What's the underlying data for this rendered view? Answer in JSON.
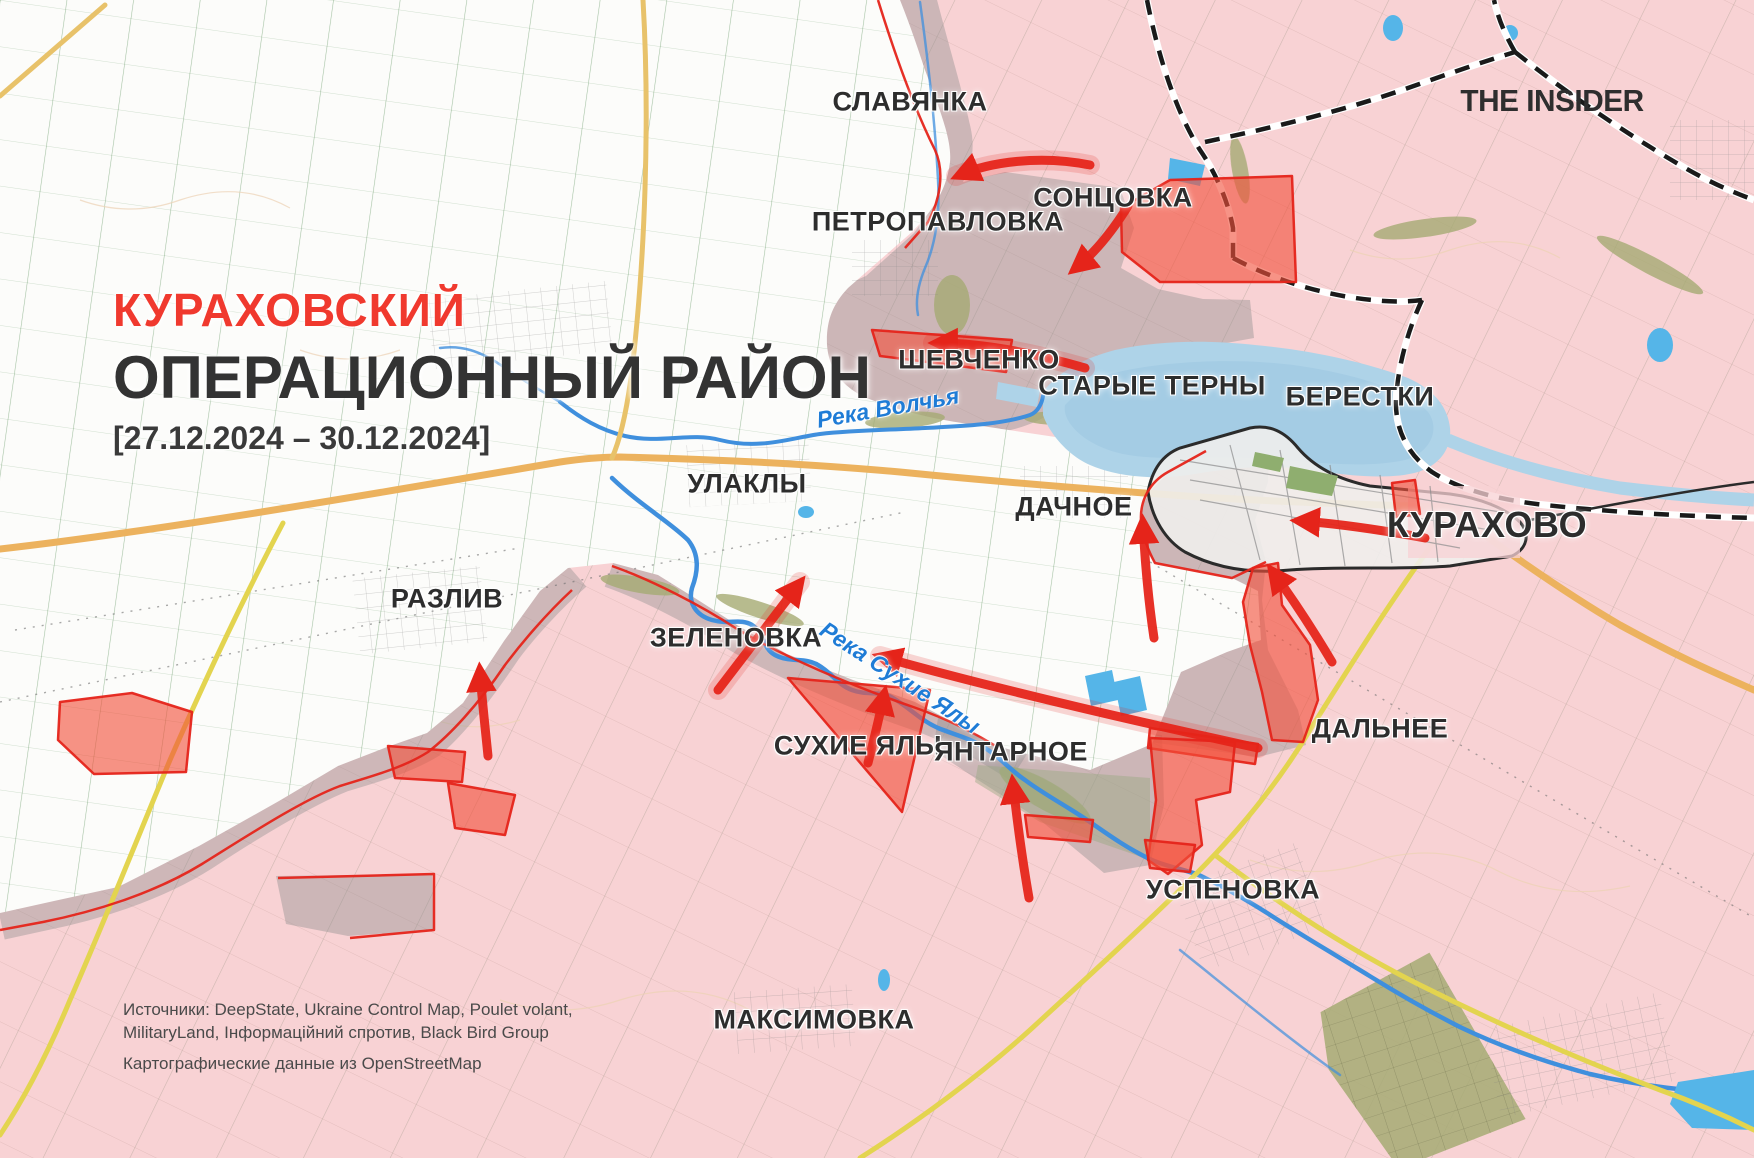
{
  "header": {
    "title_line1": "КУРАХОВСКИЙ",
    "title_line2": "ОПЕРАЦИОННЫЙ РАЙОН",
    "date_range": "[27.12.2024 – 30.12.2024]",
    "logo": "THE INSIDER"
  },
  "settlements": {
    "slavyanka": "СЛАВЯНКА",
    "petropavlovka": "ПЕТРОПАВЛОВКА",
    "sontsovka": "СОНЦОВКА",
    "shevchenko": "ШЕВЧЕНКО",
    "starye_terny": "СТАРЫЕ ТЕРНЫ",
    "berestki": "БЕРЕСТКИ",
    "ulakly": "УЛАКЛЫ",
    "dachnoe": "ДАЧНОЕ",
    "kurakhovo": "КУРАХОВО",
    "razliv": "РАЗЛИВ",
    "zelenovka": "ЗЕЛЕНОВКА",
    "sukhie_yaly": "СУХИЕ ЯЛЫ",
    "yantarnoe": "ЯНТАРНОЕ",
    "dalnee": "ДАЛЬНЕЕ",
    "uspenovka": "УСПЕНОВКА",
    "maksimovka": "МАКСИМОВКА"
  },
  "rivers": {
    "volchya": "Река Волчья",
    "sukhie_yaly": "Река Сухие Ялы"
  },
  "footer": {
    "sources_line1": "Источники: DeepState, Ukraine Control Map, Poulet volant,",
    "sources_line2": "MilitaryLand, Інформаційний спротив, Black Bird Group",
    "sources_line3": "Картографические данные из OpenStreetMap"
  },
  "colors": {
    "occupied_fill": "#f8d2d4",
    "contested_fill": "#8f8f8f",
    "advance_fill": "#f2503c",
    "front_line_red": "#e5241a",
    "arrow_red": "#e5241a",
    "river_blue": "#3f8fdd",
    "reservoir_blue": "#aed3e8",
    "pond_blue": "#55b5e8",
    "road_orange": "#ecb25e",
    "road_yellow": "#e3d44f",
    "railway_black": "#1a1a1a",
    "title_red": "#f0392e",
    "label_dark": "#2d2d2d",
    "river_label_blue": "#1f7cd6",
    "field_line_green": "#3c7d3c"
  }
}
